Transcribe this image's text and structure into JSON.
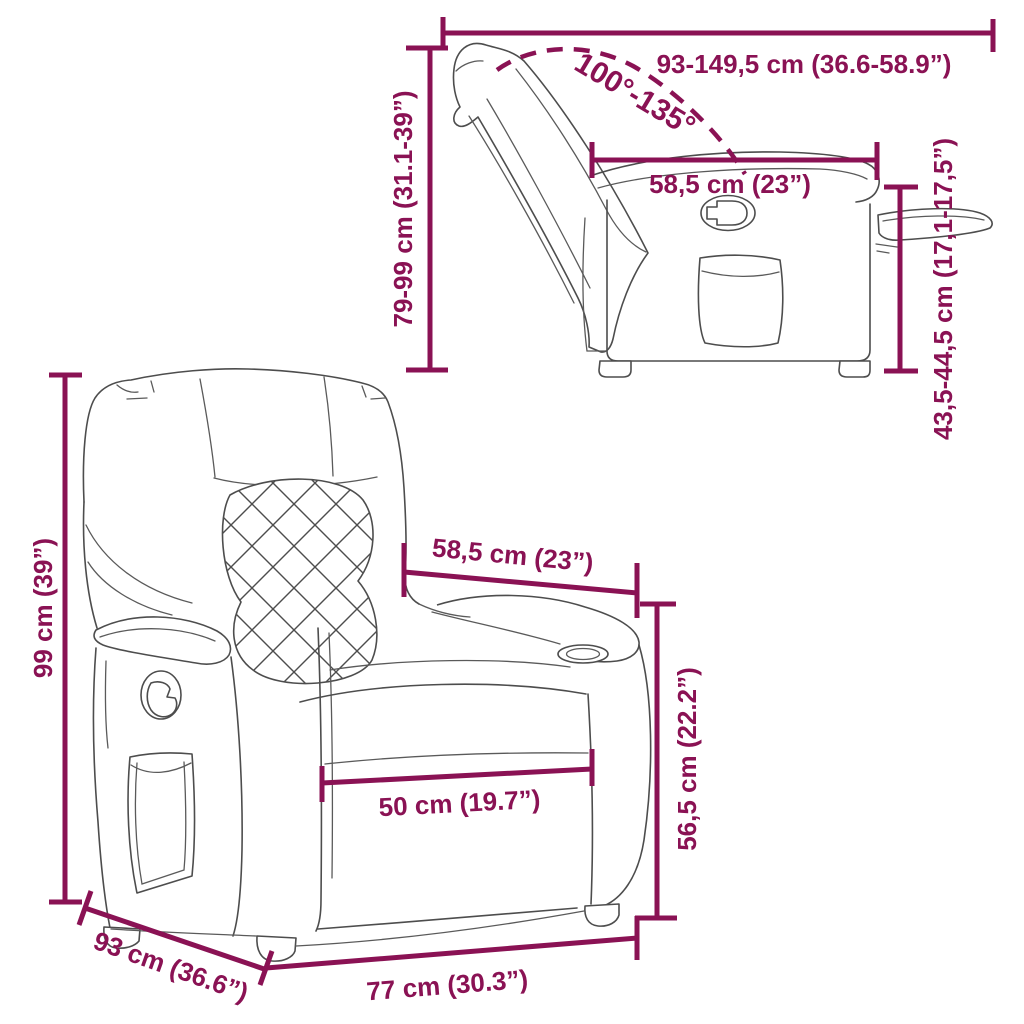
{
  "diagram": {
    "kind": "product-dimension-diagram",
    "product": "recliner-chair-line-drawing",
    "background_color": "#ffffff",
    "dimension_color": "#8a1254",
    "artwork_color": "#4d4d4d"
  },
  "side_view": {
    "title": "side view reclined",
    "labels": {
      "extension_length": "93-149,5 cm (36.6-58.9”)",
      "recline_angle": "100°-135°",
      "backrest_height": "79-99 cm (31.1-39”)",
      "seat_depth": "58,5 cm (23”)",
      "seat_height": "43,5-44,5 cm (17,1-17,5”)"
    }
  },
  "front_view": {
    "title": "front view",
    "labels": {
      "total_height": "99 cm (39”)",
      "back_width": "58,5 cm (23”)",
      "armrest_height": "56,5 cm (22.2”)",
      "seat_width": "50 cm (19.7”)",
      "total_depth": "93 cm (36.6”)",
      "total_width": "77 cm (30.3”)"
    }
  }
}
